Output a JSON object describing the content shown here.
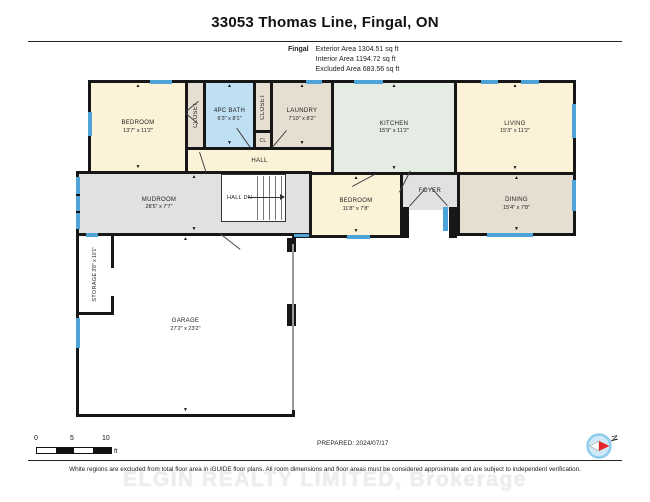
{
  "header": {
    "title": "33053 Thomas Line, Fingal, ON",
    "project": "Fingal",
    "areas": {
      "exterior": "Exterior Area 1304.51 sq ft",
      "interior": "Interior Area 1194.72 sq ft",
      "excluded": "Excluded Area 683.56 sq ft"
    }
  },
  "rooms": {
    "bedroom1": {
      "label": "BEDROOM",
      "dims": "13'7\" x 11'2\""
    },
    "closet1": {
      "label": "CLOSET"
    },
    "bath": {
      "label": "4PC BATH",
      "dims": "6'3\" x 8'1\""
    },
    "closet2": {
      "label": "CLOSET"
    },
    "laundry": {
      "label": "LAUNDRY",
      "dims": "7'10\" x 8'2\""
    },
    "cl": {
      "label": "CL"
    },
    "kitchen": {
      "label": "KITCHEN",
      "dims": "15'9\" x 11'2\""
    },
    "living": {
      "label": "LIVING",
      "dims": "15'3\" x 11'2\""
    },
    "hall": {
      "label": "HALL"
    },
    "mudroom": {
      "label": "MUDROOM",
      "dims": "28'5\" x 7'7\""
    },
    "halldn": {
      "label": "HALL DN"
    },
    "bedroom2": {
      "label": "BEDROOM",
      "dims": "11'8\" x 7'8\""
    },
    "foyer": {
      "label": "FOYER"
    },
    "dining": {
      "label": "DINING",
      "dims": "15'4\" x 7'8\""
    },
    "storage": {
      "label": "STORAGE",
      "dims": "3'8\" x 10'1\""
    },
    "garage": {
      "label": "GARAGE",
      "dims": "27'2\" x 23'2\""
    }
  },
  "scale": {
    "t0": "0",
    "t5": "5",
    "t10": "10",
    "unit": "ft"
  },
  "compass": {
    "label": "N"
  },
  "footer": {
    "prepared": "PREPARED: 2024/07/17",
    "disclaimer": "White regions are excluded from total floor area in iGUIDE floor plans. All room dimensions and floor areas must be considered approximate and are subject to independent verification.",
    "watermark": "ELGIN REALTY LIMITED, Brokerage"
  },
  "colors": {
    "wall": "#171717",
    "window": "#4EA3D8",
    "cream_room": "#FBF2D8",
    "tan_room": "#E6DED0",
    "bath_blue": "#BFDFF2",
    "kitchen_mint": "#E4ECE4",
    "gray_room": "#E1E1E1"
  }
}
